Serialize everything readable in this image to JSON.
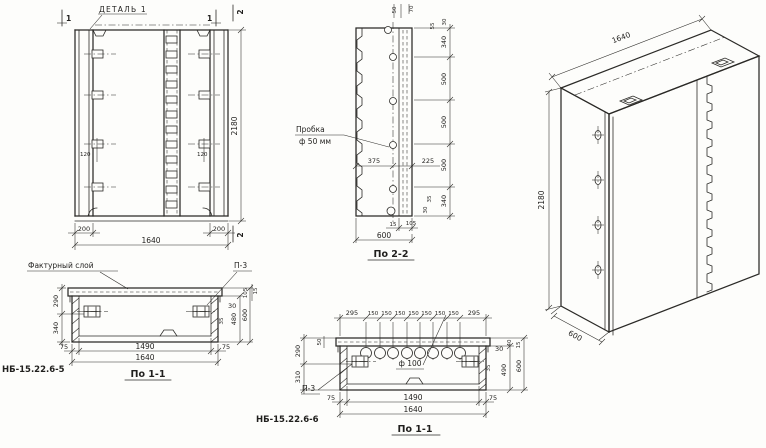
{
  "front_view": {
    "detail_label": "ДЕТАЛЬ 1",
    "cut1": "1",
    "cut2": "2",
    "dim_120_left": "120",
    "dim_120_right": "120",
    "dim_200_left": "200",
    "dim_1640": "1640",
    "dim_200_right": "200",
    "dim_2180": "2180"
  },
  "section22": {
    "title": "По 2-2",
    "plug_line1": "Пробка",
    "plug_line2": "ф 50 мм",
    "top_50": "50",
    "top_70": "70",
    "mid_375": "375",
    "mid_225": "225",
    "r_30_top": "30",
    "r_55": "55",
    "chain": [
      "340",
      "500",
      "500",
      "500",
      "340"
    ],
    "r_35_bot": "35",
    "r_30_bot": "30",
    "b_15": "15",
    "b_105": "105",
    "b_600": "600"
  },
  "iso": {
    "dim_1640": "1640",
    "dim_2180": "2180",
    "dim_600": "600"
  },
  "planA": {
    "code": "НБ-15.22.6-5",
    "title": "По 1-1",
    "texture_label": "Фактурный слой",
    "anchor_label": "П-3",
    "l_290": "290",
    "l_340": "340",
    "rt_105": "105",
    "rt_15": "15",
    "r_30": "30",
    "r_35": "35",
    "r_480": "480",
    "r_600": "600",
    "b_75l": "75",
    "b_1490": "1490",
    "b_75r": "75",
    "b_1640": "1640"
  },
  "planB": {
    "code": "НБ-15.22.6-6",
    "title": "По 1-1",
    "anchor_label": "П-3",
    "hole_label": "ф 100",
    "t_295l": "295",
    "t_150s": [
      "150",
      "150",
      "150",
      "150",
      "150",
      "150",
      "150"
    ],
    "t_295r": "295",
    "l_50": "50",
    "l_290": "290",
    "l_310": "310",
    "rt_40": "40",
    "rt_15": "15",
    "r_30": "30",
    "r_35": "35",
    "r_490": "490",
    "r_600": "600",
    "b_75l": "75",
    "b_1490": "1490",
    "b_75r": "75",
    "b_1640": "1640"
  }
}
